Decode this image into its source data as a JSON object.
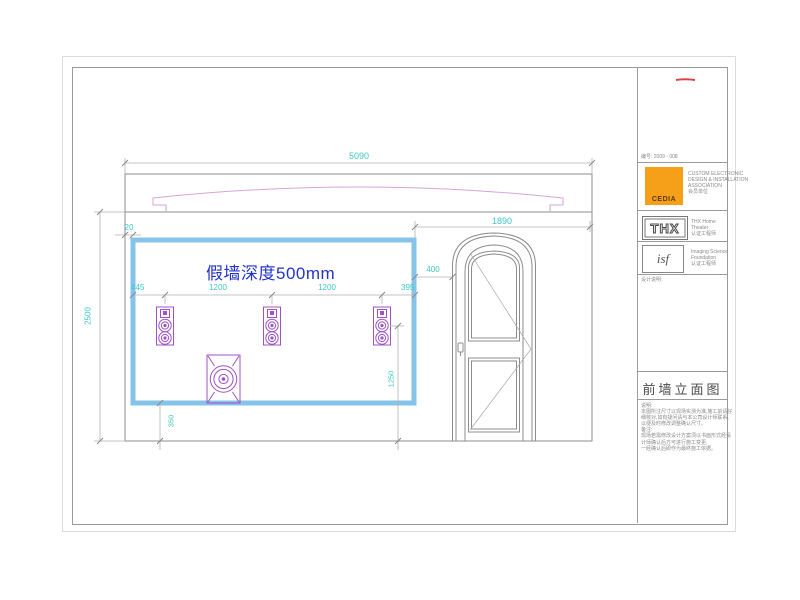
{
  "colors": {
    "dimension_cyan": "#3fc8c8",
    "annotation_blue": "#2433c9",
    "speaker_purple": "#a050c8",
    "molding_pink": "#d9a3d9",
    "false_wall_blue": "#85c3ea",
    "cedia_orange": "#f6a01a"
  },
  "drawing": {
    "annotation_false_wall": "假墙深度500mm",
    "dims": {
      "wall_width": "5090",
      "wall_height": "2500",
      "right_span": "1890",
      "wall_to_door": "400",
      "edge_gap": "20",
      "left_offset": "445",
      "speaker_spacing_1": "1200",
      "speaker_spacing_2": "1200",
      "right_offset": "395",
      "speaker_center_height": "1250",
      "bottom_offset": "350"
    }
  },
  "title_block": {
    "doc_no_line": "编号: 2009 - 008",
    "cedia": {
      "logo": "CEDIA",
      "lines": [
        "CUSTOM ELECTRONIC",
        "DESIGN & INSTALLATION",
        "ASSOCIATION",
        "会员单位"
      ]
    },
    "thx": {
      "logo": "THX",
      "lines": [
        "THX Home",
        "Theater",
        "认证工程师"
      ]
    },
    "isf": {
      "logo": "isf",
      "lines": [
        "Imaging Science",
        "Foundation",
        "认证工程师"
      ]
    },
    "design_note_label": "设计说明:",
    "sheet_title": "前墙立面图",
    "notes": [
      "说明:",
      "本图所注尺寸以现场实测为准,施工前请仔",
      "细核对,如有疑问请与本公司设计师联系,",
      "以便及时修改调整确认尺寸。",
      "备注:",
      "现场若需修改设计方案须以书面形式经设",
      "计师确认后方可进行施工变更,",
      "一经确认后即作为最终施工依据。"
    ]
  }
}
